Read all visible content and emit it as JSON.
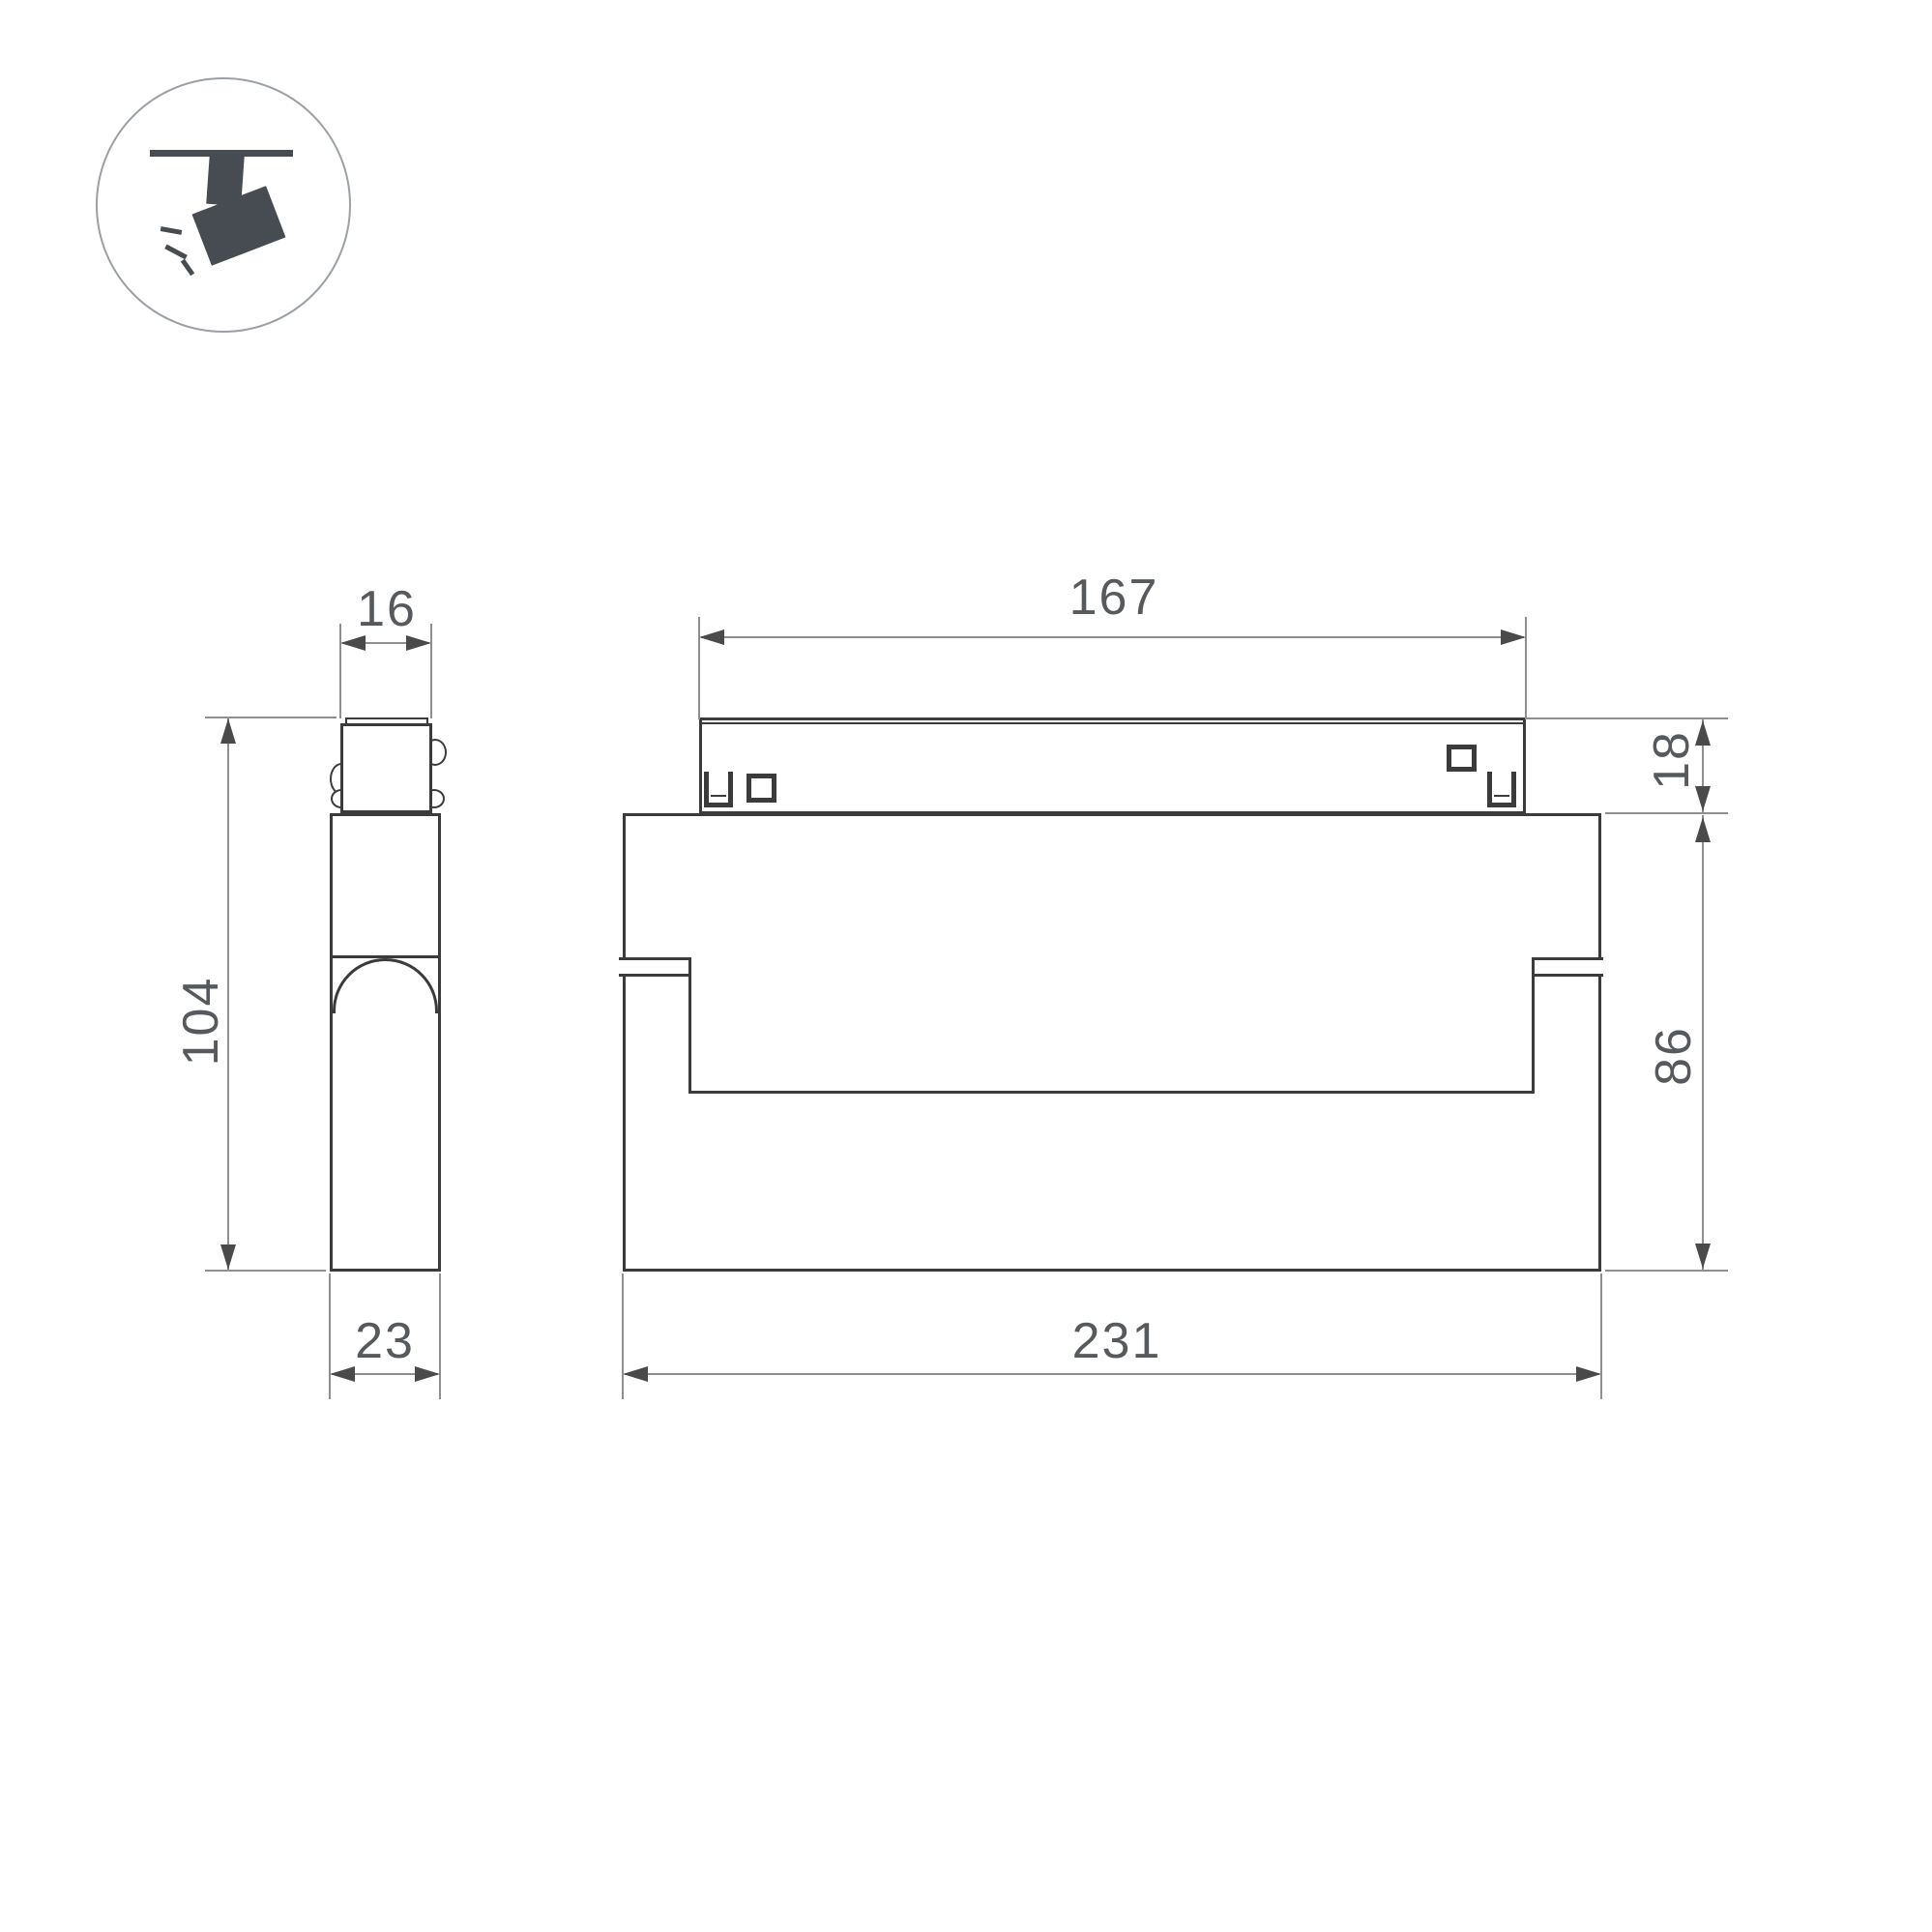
{
  "colors": {
    "outline": "#3b3b3b",
    "dimension_line": "#8f8f8f",
    "arrow": "#4a4a4a",
    "text": "#56595d",
    "icon": "#474c52",
    "icon_circle": "#9aa0a5",
    "background": "#ffffff"
  },
  "icon": {
    "name": "ceiling-track-spotlight"
  },
  "side_view": {
    "top_width": "16",
    "height": "104",
    "bottom_width": "23"
  },
  "front_view": {
    "track_length": "167",
    "track_height": "18",
    "body_height": "86",
    "body_width": "231"
  }
}
